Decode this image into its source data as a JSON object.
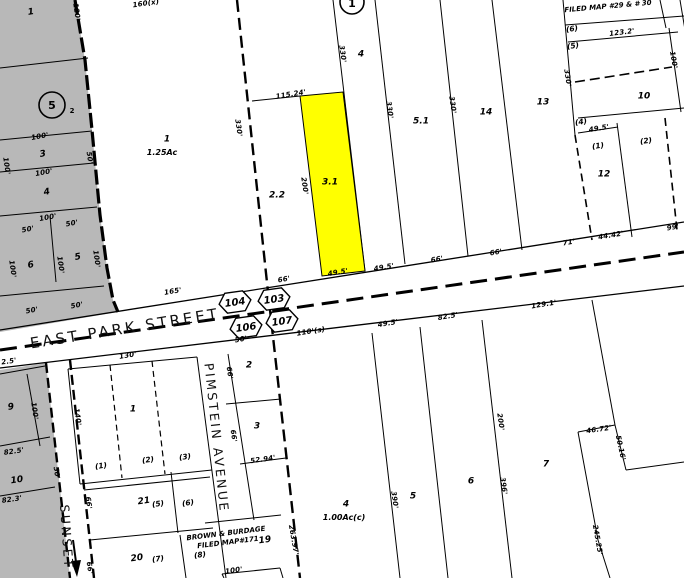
{
  "colors": {
    "highlight": "#ffff00",
    "zone_gray": "#b8b8b8",
    "line": "#000000",
    "paper": "#ffffff"
  },
  "map": {
    "highlight_parcel": {
      "id": "3.1",
      "color": "#ffff00"
    },
    "badges": {
      "hex": [
        {
          "label": "104",
          "x": 235,
          "y": 302
        },
        {
          "label": "103",
          "x": 274,
          "y": 299
        },
        {
          "label": "106",
          "x": 246,
          "y": 327
        },
        {
          "label": "107",
          "x": 282,
          "y": 321
        }
      ],
      "circle5": {
        "label": "5",
        "sub": "2",
        "x": 52,
        "y": 105
      },
      "circle1": {
        "label": "1",
        "x": 352,
        "y": 2
      }
    },
    "streets": {
      "east_park": "EAST PARK STREET",
      "pimstein": "PIMSTEIN  AVENUE",
      "sunset": "SUNSET"
    },
    "notes": {
      "filed_map_top": "FILED MAP #29 & # 30",
      "brown1": "BROWN & BURDAGE",
      "brown2": "FILED MAP#171"
    },
    "labels": [
      {
        "t": "1",
        "x": 31,
        "y": 13,
        "r": -8,
        "k": "p"
      },
      {
        "t": "100'",
        "x": 40,
        "y": 137,
        "r": -10,
        "k": "d"
      },
      {
        "t": "3",
        "x": 43,
        "y": 155,
        "r": -10,
        "k": "p"
      },
      {
        "t": "100'",
        "x": 44,
        "y": 173,
        "r": -10,
        "k": "d"
      },
      {
        "t": "4",
        "x": 47,
        "y": 193,
        "r": -10,
        "k": "p"
      },
      {
        "t": "100'",
        "x": 48,
        "y": 218,
        "r": -10,
        "k": "d"
      },
      {
        "t": "50'",
        "x": 28,
        "y": 230,
        "r": -10,
        "k": "d"
      },
      {
        "t": "50'",
        "x": 72,
        "y": 224,
        "r": -10,
        "k": "d"
      },
      {
        "t": "6",
        "x": 31,
        "y": 266,
        "r": -10,
        "k": "p"
      },
      {
        "t": "5",
        "x": 78,
        "y": 258,
        "r": -10,
        "k": "p"
      },
      {
        "t": "50'",
        "x": 32,
        "y": 311,
        "r": -10,
        "k": "d"
      },
      {
        "t": "50'",
        "x": 77,
        "y": 306,
        "r": -10,
        "k": "d"
      },
      {
        "t": "120'",
        "x": 76,
        "y": 12,
        "r": 82,
        "k": "d"
      },
      {
        "t": "100'",
        "x": 6,
        "y": 166,
        "r": 82,
        "k": "d"
      },
      {
        "t": "50'",
        "x": 89,
        "y": 158,
        "r": 82,
        "k": "d"
      },
      {
        "t": "100'",
        "x": 12,
        "y": 269,
        "r": 82,
        "k": "d"
      },
      {
        "t": "100'",
        "x": 60,
        "y": 265,
        "r": 82,
        "k": "d"
      },
      {
        "t": "100'",
        "x": 96,
        "y": 259,
        "r": 82,
        "k": "d"
      },
      {
        "t": "160(x)",
        "x": 146,
        "y": 4,
        "r": -8,
        "k": "d"
      },
      {
        "t": "1",
        "x": 167,
        "y": 140,
        "r": 0,
        "k": "p"
      },
      {
        "t": "1.25Ac",
        "x": 162,
        "y": 153,
        "r": 0,
        "k": "p2"
      },
      {
        "t": "330'",
        "x": 238,
        "y": 128,
        "r": 82,
        "k": "d"
      },
      {
        "t": "115.24'",
        "x": 291,
        "y": 95,
        "r": -9,
        "k": "d"
      },
      {
        "t": "2.2",
        "x": 277,
        "y": 196,
        "r": 0,
        "k": "p"
      },
      {
        "t": "200'",
        "x": 304,
        "y": 186,
        "r": 82,
        "k": "d"
      },
      {
        "t": "3.1",
        "x": 330,
        "y": 183,
        "r": 0,
        "k": "p"
      },
      {
        "t": "4",
        "x": 361,
        "y": 55,
        "r": 0,
        "k": "p"
      },
      {
        "t": "330'",
        "x": 342,
        "y": 54,
        "r": 82,
        "k": "d"
      },
      {
        "t": "5.1",
        "x": 421,
        "y": 122,
        "r": 0,
        "k": "p"
      },
      {
        "t": "330'",
        "x": 389,
        "y": 110,
        "r": 82,
        "k": "d"
      },
      {
        "t": "330'",
        "x": 452,
        "y": 105,
        "r": 82,
        "k": "d"
      },
      {
        "t": "14",
        "x": 486,
        "y": 113,
        "r": 0,
        "k": "p"
      },
      {
        "t": "13",
        "x": 543,
        "y": 103,
        "r": 0,
        "k": "p"
      },
      {
        "t": "330'",
        "x": 567,
        "y": 78,
        "r": 82,
        "k": "d"
      },
      {
        "t": "(6)",
        "x": 572,
        "y": 29,
        "r": -8,
        "k": "s"
      },
      {
        "t": "123.2'",
        "x": 622,
        "y": 33,
        "r": -7,
        "k": "d"
      },
      {
        "t": "(5)",
        "x": 573,
        "y": 46,
        "r": -8,
        "k": "s"
      },
      {
        "t": "100'",
        "x": 673,
        "y": 60,
        "r": 80,
        "k": "d"
      },
      {
        "t": "10",
        "x": 644,
        "y": 97,
        "r": 0,
        "k": "p"
      },
      {
        "t": "(4)",
        "x": 581,
        "y": 122,
        "r": -8,
        "k": "s"
      },
      {
        "t": "49.5'",
        "x": 599,
        "y": 129,
        "r": -9,
        "k": "d"
      },
      {
        "t": "(1)",
        "x": 598,
        "y": 146,
        "r": -8,
        "k": "s"
      },
      {
        "t": "(2)",
        "x": 646,
        "y": 141,
        "r": -8,
        "k": "s"
      },
      {
        "t": "12",
        "x": 604,
        "y": 175,
        "r": 0,
        "k": "p"
      },
      {
        "t": "44.42'",
        "x": 611,
        "y": 236,
        "r": -9,
        "k": "d"
      },
      {
        "t": "99'",
        "x": 673,
        "y": 228,
        "r": -9,
        "k": "d"
      },
      {
        "t": "71'",
        "x": 569,
        "y": 243,
        "r": -9,
        "k": "d"
      },
      {
        "t": "165'",
        "x": 173,
        "y": 292,
        "r": -9,
        "k": "d"
      },
      {
        "t": "66'",
        "x": 284,
        "y": 280,
        "r": -9,
        "k": "d"
      },
      {
        "t": "49.5'",
        "x": 338,
        "y": 273,
        "r": -9,
        "k": "d"
      },
      {
        "t": "49.5'",
        "x": 384,
        "y": 268,
        "r": -9,
        "k": "d"
      },
      {
        "t": "66'",
        "x": 437,
        "y": 260,
        "r": -9,
        "k": "d"
      },
      {
        "t": "66'",
        "x": 496,
        "y": 253,
        "r": -9,
        "k": "d"
      },
      {
        "t": "50'",
        "x": 241,
        "y": 340,
        "r": -9,
        "k": "d"
      },
      {
        "t": "110'(s)",
        "x": 311,
        "y": 332,
        "r": -9,
        "k": "d"
      },
      {
        "t": "49.5'",
        "x": 388,
        "y": 324,
        "r": -9,
        "k": "d"
      },
      {
        "t": "82.5'",
        "x": 448,
        "y": 317,
        "r": -9,
        "k": "d"
      },
      {
        "t": "129.1'",
        "x": 544,
        "y": 305,
        "r": -9,
        "k": "d"
      },
      {
        "t": "130'",
        "x": 128,
        "y": 356,
        "r": -9,
        "k": "d"
      },
      {
        "t": "1",
        "x": 133,
        "y": 410,
        "r": 0,
        "k": "p"
      },
      {
        "t": "140'",
        "x": 77,
        "y": 417,
        "r": 82,
        "k": "d"
      },
      {
        "t": "(1)",
        "x": 101,
        "y": 466,
        "r": -8,
        "k": "s"
      },
      {
        "t": "(2)",
        "x": 148,
        "y": 460,
        "r": -8,
        "k": "s"
      },
      {
        "t": "(3)",
        "x": 185,
        "y": 457,
        "r": -8,
        "k": "s"
      },
      {
        "t": "2",
        "x": 249,
        "y": 366,
        "r": 0,
        "k": "p"
      },
      {
        "t": "66'",
        "x": 229,
        "y": 373,
        "r": 82,
        "k": "d"
      },
      {
        "t": "3",
        "x": 257,
        "y": 427,
        "r": 0,
        "k": "p"
      },
      {
        "t": "66'",
        "x": 233,
        "y": 436,
        "r": 82,
        "k": "d"
      },
      {
        "t": "52.94'",
        "x": 263,
        "y": 460,
        "r": -8,
        "k": "d"
      },
      {
        "t": "2.5'",
        "x": 9,
        "y": 362,
        "r": -8,
        "k": "d"
      },
      {
        "t": "9",
        "x": 11,
        "y": 408,
        "r": -8,
        "k": "p"
      },
      {
        "t": "100'",
        "x": 34,
        "y": 411,
        "r": 82,
        "k": "d"
      },
      {
        "t": "82.5'",
        "x": 14,
        "y": 452,
        "r": -8,
        "k": "d"
      },
      {
        "t": "10",
        "x": 17,
        "y": 481,
        "r": -8,
        "k": "p"
      },
      {
        "t": "82.3'",
        "x": 12,
        "y": 500,
        "r": -8,
        "k": "d"
      },
      {
        "t": "50'",
        "x": 56,
        "y": 473,
        "r": 82,
        "k": "d"
      },
      {
        "t": "66'",
        "x": 88,
        "y": 503,
        "r": 82,
        "k": "d"
      },
      {
        "t": "66'",
        "x": 89,
        "y": 568,
        "r": 82,
        "k": "d"
      },
      {
        "t": "21",
        "x": 144,
        "y": 502,
        "r": -8,
        "k": "p"
      },
      {
        "t": "(5)",
        "x": 158,
        "y": 504,
        "r": -8,
        "k": "s"
      },
      {
        "t": "(6)",
        "x": 188,
        "y": 503,
        "r": -8,
        "k": "s"
      },
      {
        "t": "20",
        "x": 137,
        "y": 559,
        "r": -8,
        "k": "p"
      },
      {
        "t": "(7)",
        "x": 158,
        "y": 559,
        "r": -8,
        "k": "s"
      },
      {
        "t": "19",
        "x": 265,
        "y": 541,
        "r": -8,
        "k": "p"
      },
      {
        "t": "(8)",
        "x": 200,
        "y": 555,
        "r": -8,
        "k": "s"
      },
      {
        "t": "100'",
        "x": 234,
        "y": 571,
        "r": -8,
        "k": "d"
      },
      {
        "t": "263.97'",
        "x": 293,
        "y": 540,
        "r": 80,
        "k": "d"
      },
      {
        "t": "4",
        "x": 346,
        "y": 505,
        "r": 0,
        "k": "p"
      },
      {
        "t": "1.00Ac(c)",
        "x": 344,
        "y": 518,
        "r": 0,
        "k": "p2"
      },
      {
        "t": "5",
        "x": 413,
        "y": 497,
        "r": 0,
        "k": "p"
      },
      {
        "t": "390'",
        "x": 394,
        "y": 500,
        "r": 82,
        "k": "d"
      },
      {
        "t": "6",
        "x": 471,
        "y": 482,
        "r": 0,
        "k": "p"
      },
      {
        "t": "396'",
        "x": 503,
        "y": 486,
        "r": 82,
        "k": "d"
      },
      {
        "t": "200'",
        "x": 500,
        "y": 422,
        "r": 82,
        "k": "d"
      },
      {
        "t": "7",
        "x": 546,
        "y": 465,
        "r": 0,
        "k": "p"
      },
      {
        "t": "46.72'",
        "x": 599,
        "y": 430,
        "r": -8,
        "k": "d"
      },
      {
        "t": "50.16'",
        "x": 620,
        "y": 448,
        "r": 78,
        "k": "d"
      },
      {
        "t": "245.25'",
        "x": 597,
        "y": 540,
        "r": 80,
        "k": "d"
      }
    ]
  }
}
